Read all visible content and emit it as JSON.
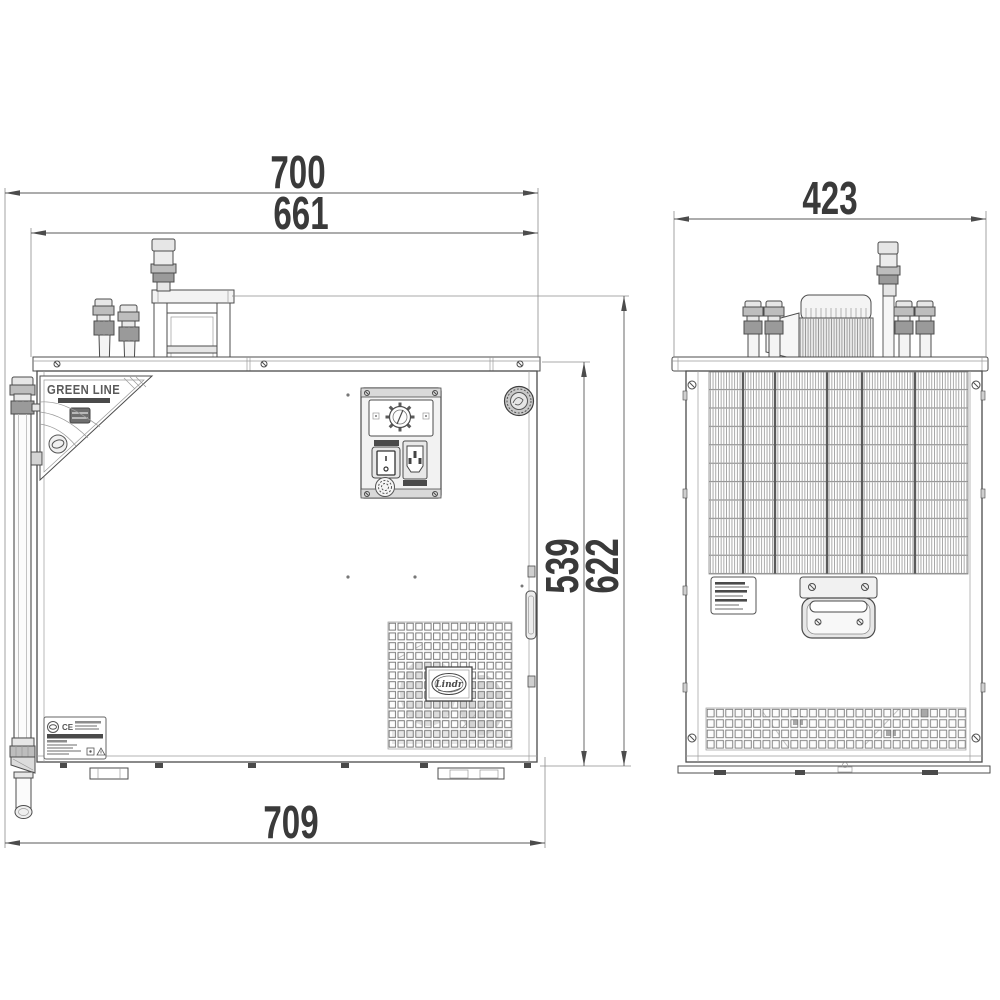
{
  "dimensions": {
    "top_width": "700",
    "inner_width": "661",
    "side_width": "423",
    "cabinet_height": "539",
    "total_height": "622",
    "bottom_width": "709"
  },
  "branding": {
    "sticker_title": "GREEN LINE",
    "oval_logo": "Lindr"
  },
  "rating_plate": {
    "ce_mark": "CE"
  },
  "colors": {
    "background": "#ffffff",
    "line": "#4c4c4c",
    "dim_text": "#3a3a3a",
    "metal_light": "#e6e6e6",
    "metal_mid": "#bdbdbd",
    "metal_dark": "#9a9a9a"
  }
}
